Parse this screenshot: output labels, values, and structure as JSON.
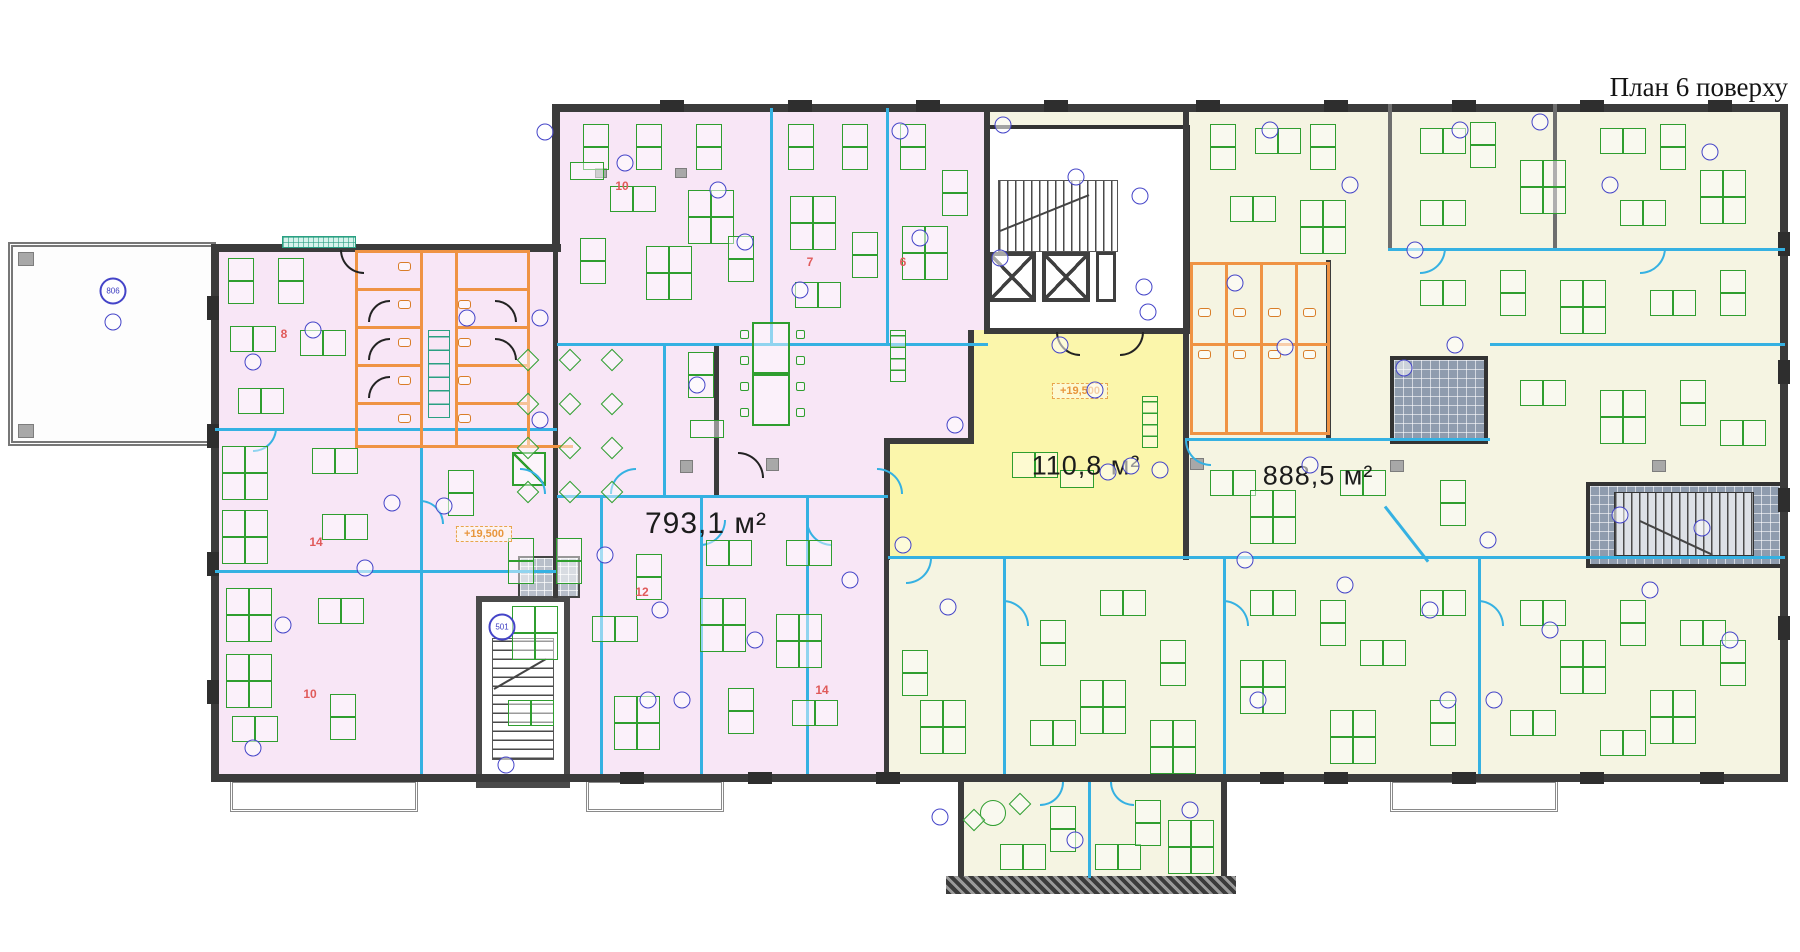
{
  "title": {
    "text": "План 6 поверху"
  },
  "plan": {
    "areas": [
      {
        "label": "793,1 м²",
        "x": 706,
        "y": 524,
        "size": 30
      },
      {
        "label": "110,8 м²",
        "x": 1086,
        "y": 466,
        "size": 27
      },
      {
        "label": "888,5 м²",
        "x": 1318,
        "y": 476,
        "size": 27
      }
    ],
    "elevation_marks": [
      {
        "label": "+19,500",
        "x": 484,
        "y": 534
      },
      {
        "label": "+19,500",
        "x": 1080,
        "y": 391
      }
    ],
    "room_numbers": [
      {
        "label": "8",
        "x": 284,
        "y": 334
      },
      {
        "label": "10",
        "x": 622,
        "y": 186
      },
      {
        "label": "7",
        "x": 810,
        "y": 262
      },
      {
        "label": "6",
        "x": 903,
        "y": 262
      },
      {
        "label": "14",
        "x": 316,
        "y": 542
      },
      {
        "label": "12",
        "x": 642,
        "y": 592
      },
      {
        "label": "14",
        "x": 822,
        "y": 690
      },
      {
        "label": "10",
        "x": 310,
        "y": 694
      }
    ],
    "markers": [
      {
        "x": 113,
        "y": 291,
        "label": "806"
      },
      {
        "x": 113,
        "y": 322,
        "label": ""
      },
      {
        "x": 253,
        "y": 362,
        "label": ""
      },
      {
        "x": 313,
        "y": 330,
        "label": ""
      },
      {
        "x": 467,
        "y": 318,
        "label": ""
      },
      {
        "x": 540,
        "y": 318,
        "label": ""
      },
      {
        "x": 392,
        "y": 503,
        "label": ""
      },
      {
        "x": 444,
        "y": 506,
        "label": ""
      },
      {
        "x": 365,
        "y": 568,
        "label": ""
      },
      {
        "x": 283,
        "y": 625,
        "label": ""
      },
      {
        "x": 253,
        "y": 748,
        "label": ""
      },
      {
        "x": 502,
        "y": 627,
        "label": "501"
      },
      {
        "x": 506,
        "y": 765,
        "label": ""
      },
      {
        "x": 545,
        "y": 132,
        "label": ""
      },
      {
        "x": 625,
        "y": 163,
        "label": ""
      },
      {
        "x": 718,
        "y": 190,
        "label": ""
      },
      {
        "x": 745,
        "y": 242,
        "label": ""
      },
      {
        "x": 900,
        "y": 131,
        "label": ""
      },
      {
        "x": 920,
        "y": 238,
        "label": ""
      },
      {
        "x": 800,
        "y": 290,
        "label": ""
      },
      {
        "x": 697,
        "y": 385,
        "label": ""
      },
      {
        "x": 540,
        "y": 420,
        "label": ""
      },
      {
        "x": 605,
        "y": 555,
        "label": ""
      },
      {
        "x": 660,
        "y": 610,
        "label": ""
      },
      {
        "x": 755,
        "y": 640,
        "label": ""
      },
      {
        "x": 850,
        "y": 580,
        "label": ""
      },
      {
        "x": 1003,
        "y": 125,
        "label": ""
      },
      {
        "x": 1076,
        "y": 177,
        "label": ""
      },
      {
        "x": 1140,
        "y": 196,
        "label": ""
      },
      {
        "x": 1000,
        "y": 258,
        "label": ""
      },
      {
        "x": 1144,
        "y": 287,
        "label": ""
      },
      {
        "x": 1148,
        "y": 312,
        "label": ""
      },
      {
        "x": 1060,
        "y": 345,
        "label": ""
      },
      {
        "x": 1095,
        "y": 390,
        "label": ""
      },
      {
        "x": 1131,
        "y": 466,
        "label": ""
      },
      {
        "x": 955,
        "y": 425,
        "label": ""
      },
      {
        "x": 903,
        "y": 545,
        "label": ""
      },
      {
        "x": 948,
        "y": 607,
        "label": ""
      },
      {
        "x": 1108,
        "y": 472,
        "label": ""
      },
      {
        "x": 1160,
        "y": 470,
        "label": ""
      },
      {
        "x": 1235,
        "y": 283,
        "label": ""
      },
      {
        "x": 1285,
        "y": 347,
        "label": ""
      },
      {
        "x": 1310,
        "y": 465,
        "label": ""
      },
      {
        "x": 1270,
        "y": 130,
        "label": ""
      },
      {
        "x": 1350,
        "y": 185,
        "label": ""
      },
      {
        "x": 1460,
        "y": 130,
        "label": ""
      },
      {
        "x": 1540,
        "y": 122,
        "label": ""
      },
      {
        "x": 1610,
        "y": 185,
        "label": ""
      },
      {
        "x": 1710,
        "y": 152,
        "label": ""
      },
      {
        "x": 1415,
        "y": 250,
        "label": ""
      },
      {
        "x": 1455,
        "y": 345,
        "label": ""
      },
      {
        "x": 1404,
        "y": 368,
        "label": ""
      },
      {
        "x": 1620,
        "y": 515,
        "label": ""
      },
      {
        "x": 1702,
        "y": 528,
        "label": ""
      },
      {
        "x": 1488,
        "y": 540,
        "label": ""
      },
      {
        "x": 1245,
        "y": 560,
        "label": ""
      },
      {
        "x": 1345,
        "y": 585,
        "label": ""
      },
      {
        "x": 1430,
        "y": 610,
        "label": ""
      },
      {
        "x": 1550,
        "y": 630,
        "label": ""
      },
      {
        "x": 1650,
        "y": 590,
        "label": ""
      },
      {
        "x": 1730,
        "y": 640,
        "label": ""
      },
      {
        "x": 1258,
        "y": 700,
        "label": ""
      },
      {
        "x": 1448,
        "y": 700,
        "label": ""
      },
      {
        "x": 1494,
        "y": 700,
        "label": ""
      },
      {
        "x": 648,
        "y": 700,
        "label": ""
      },
      {
        "x": 682,
        "y": 700,
        "label": ""
      },
      {
        "x": 940,
        "y": 817,
        "label": ""
      },
      {
        "x": 1075,
        "y": 840,
        "label": ""
      },
      {
        "x": 1190,
        "y": 810,
        "label": ""
      }
    ]
  },
  "colors": {
    "zone_pink": "#f8e6f6",
    "zone_yellow": "#fbf6ab",
    "zone_cream": "#f5f4e2",
    "wall": "#3b3b3b",
    "partition": "#35b1e2",
    "sanitary": "#ef9344",
    "furniture": "#2f9e2f",
    "marker": "#4444c8",
    "room_number": "#e05a5a",
    "elevation": "#e8963c"
  }
}
